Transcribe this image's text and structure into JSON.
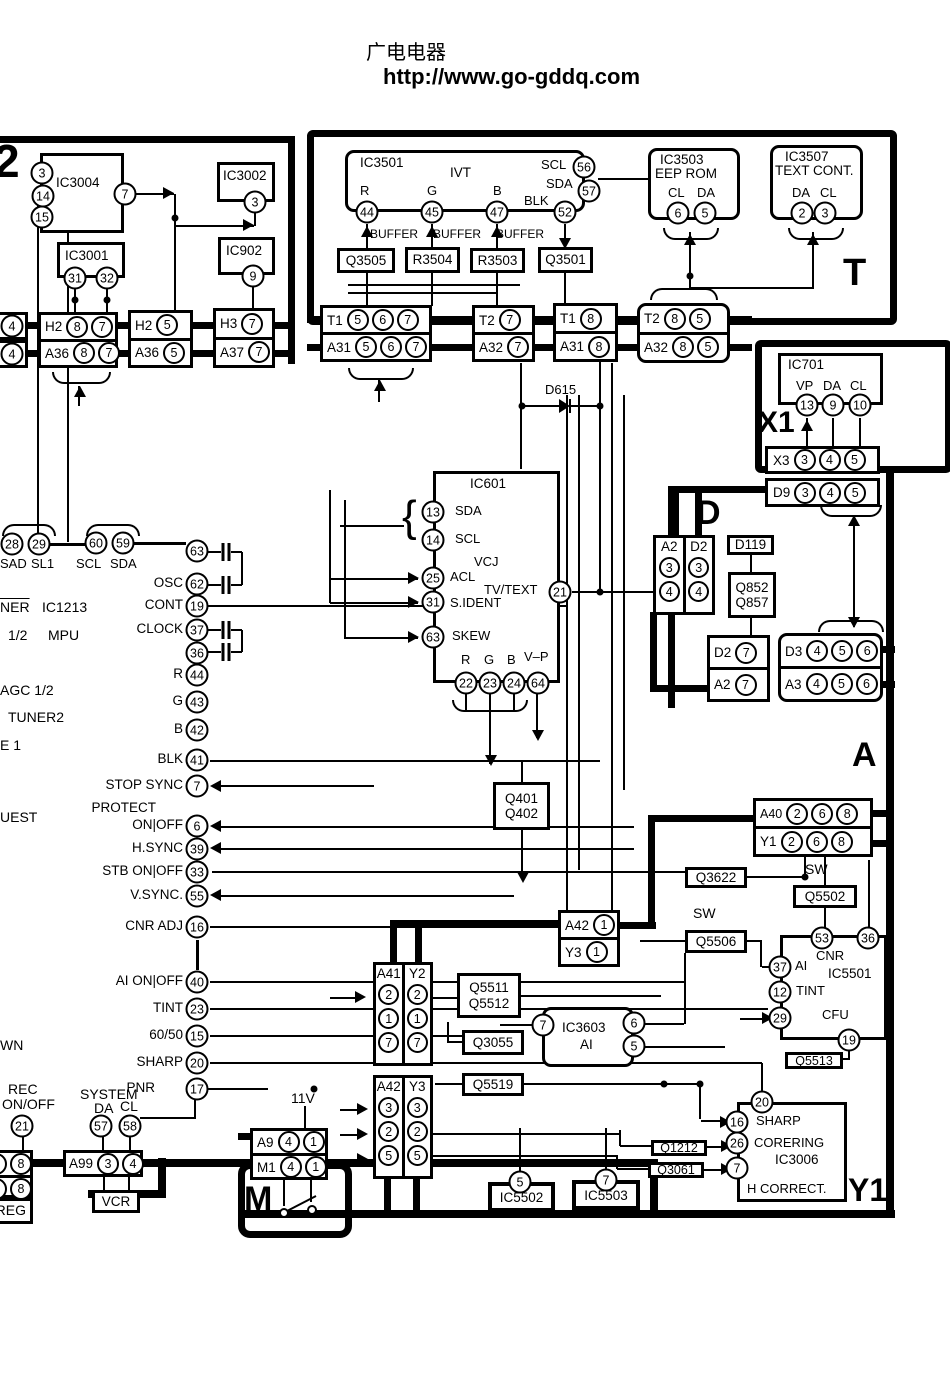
{
  "header": {
    "site": "广电电器",
    "url": "http://www.go-gddq.com"
  },
  "sections": {
    "s2": "2",
    "t": "T",
    "x1": "X1",
    "d": "D",
    "a": "A",
    "m": "M",
    "y1": "Y1"
  },
  "top_left": {
    "ic3004": {
      "t": "IC3004",
      "p3": "3",
      "p14": "14",
      "p15": "15",
      "p7": "7"
    },
    "ic3002": {
      "t": "IC3002",
      "p3": "3"
    },
    "ic3001": {
      "t": "IC3001",
      "p31": "31",
      "p32": "32"
    },
    "ic902": {
      "t": "IC902",
      "p9": "9"
    },
    "edge": {
      "r1": "4",
      "r2": "4"
    },
    "hbox1": {
      "l1": "H2",
      "p11": "8",
      "p12": "7",
      "l2": "A36",
      "p21": "8",
      "p22": "7"
    },
    "hbox2": {
      "l1": "H2",
      "p11": "5",
      "l2": "A36",
      "p21": "5"
    },
    "hbox3": {
      "l1": "H3",
      "p11": "7",
      "l2": "A37",
      "p21": "7"
    }
  },
  "t_sec": {
    "ic3501": {
      "t": "IC3501",
      "sub": "IVT",
      "lr": "R",
      "lg": "G",
      "lb": "B",
      "lblk": "BLK",
      "lscl": "SCL",
      "lsda": "SDA",
      "p44": "44",
      "p45": "45",
      "p47": "47",
      "p52": "52",
      "p56": "56",
      "p57": "57"
    },
    "buf": "BUFFER",
    "q3505": "Q3505",
    "r3504": "R3504",
    "r3503": "R3503",
    "q3501": "Q3501",
    "ic3503": {
      "t": "IC3503",
      "sub": "EEP ROM",
      "lcl": "CL",
      "lda": "DA",
      "p6": "6",
      "p5": "5"
    },
    "ic3507": {
      "t": "IC3507",
      "sub": "TEXT CONT.",
      "lda": "DA",
      "lcl": "CL",
      "p2": "2",
      "p3": "3"
    },
    "tbox1": {
      "l1": "T1",
      "p1": [
        "5",
        "6",
        "7"
      ],
      "l2": "A31",
      "p2": [
        "5",
        "6",
        "7"
      ]
    },
    "tbox2": {
      "l1": "T2",
      "p1": [
        "7"
      ],
      "l2": "A32",
      "p2": [
        "7"
      ]
    },
    "tbox3": {
      "l1": "T1",
      "p1": [
        "8"
      ],
      "l2": "A31",
      "p2": [
        "8"
      ]
    },
    "tbox4": {
      "l1": "T2",
      "p1": [
        "8",
        "5"
      ],
      "l2": "A32",
      "p2": [
        "8",
        "5"
      ]
    },
    "d615": "D615"
  },
  "x1_sec": {
    "ic701": {
      "t": "IC701",
      "lvp": "VP",
      "lda": "DA",
      "lcl": "CL",
      "p13": "13",
      "p9": "9",
      "p10": "10"
    },
    "x3": {
      "l": "X3",
      "p": [
        "3",
        "4",
        "5"
      ]
    },
    "d9": {
      "l": "D9",
      "p": [
        "3",
        "4",
        "5"
      ]
    }
  },
  "mpu": {
    "p28": "28",
    "p29": "29",
    "lsad": "SAD",
    "lsl1": "SL1",
    "p60": "60",
    "p59": "59",
    "lscl": "SCL",
    "lsda": "SDA",
    "f_ner": "NER",
    "f_ic1213": "IC1213",
    "f_half": "1/2",
    "f_mpu": "MPU",
    "f_agc": "AGC 1/2",
    "f_tuner2": "TUNER2",
    "f_e1": "E 1",
    "f_uest": "UEST",
    "f_wn": "WN",
    "pins": [
      {
        "l": "",
        "n": "63"
      },
      {
        "l": "OSC",
        "n": "62"
      },
      {
        "l": "CONT",
        "n": "19"
      },
      {
        "l": "CLOCK",
        "n": "37"
      },
      {
        "l": "",
        "n": "36"
      },
      {
        "l": "R",
        "n": "44"
      },
      {
        "l": "G",
        "n": "43"
      },
      {
        "l": "B",
        "n": "42"
      },
      {
        "l": "BLK",
        "n": "41"
      },
      {
        "l": "STOP SYNC",
        "n": "7"
      },
      {
        "l": "ON|OFF",
        "n": "6",
        "pre": "PROTECT"
      },
      {
        "l": "H.SYNC",
        "n": "39"
      },
      {
        "l": "STB ON|OFF",
        "n": "33"
      },
      {
        "l": "V.SYNC.",
        "n": "55"
      },
      {
        "l": "CNR ADJ",
        "n": "16"
      },
      {
        "l": "AI ON|OFF",
        "n": "40"
      },
      {
        "l": "TINT",
        "n": "23"
      },
      {
        "l": "60/50",
        "n": "15"
      },
      {
        "l": "SHARP",
        "n": "20"
      },
      {
        "l": "PNR",
        "n": "17"
      }
    ],
    "rec1": "REC",
    "rec2": "ON/OFF",
    "p21": "21",
    "system": "SYSTEM",
    "lda": "DA",
    "lcl": "CL",
    "p57": "57",
    "p58": "58"
  },
  "ic601": {
    "t": "IC601",
    "p13": "13",
    "lsda": "SDA",
    "p14": "14",
    "lscl": "SCL",
    "lvcj": "VCJ",
    "p25": "25",
    "lacl": "ACL",
    "ltv": "TV/TEXT",
    "p21": "21",
    "p31": "31",
    "lsident": "S.IDENT",
    "p63": "63",
    "lskew": "SKEW",
    "lr": "R",
    "lg": "G",
    "lb": "B",
    "lvp": "V–P",
    "p22": "22",
    "p23": "23",
    "p24": "24",
    "p64": "64"
  },
  "d_sec": {
    "cols": {
      "h1": "A2",
      "h2": "D2",
      "r1a": "3",
      "r1b": "3",
      "r2a": "4",
      "r2b": "4"
    },
    "d119": "D119",
    "q852": "Q852",
    "q857": "Q857",
    "box2": {
      "l1": "D2",
      "p1": "7",
      "l2": "A2",
      "p2": "7"
    },
    "box3": {
      "l1": "D3",
      "p1": [
        "4",
        "5",
        "6"
      ],
      "l2": "A3",
      "p2": [
        "4",
        "5",
        "6"
      ]
    }
  },
  "mid": {
    "q401": "Q401",
    "q402": "Q402",
    "a40": {
      "l1": "A40",
      "p1": [
        "2",
        "6",
        "8"
      ],
      "l2": "Y1",
      "p2": [
        "2",
        "6",
        "8"
      ]
    },
    "q3622": "Q3622",
    "sw1": "SW",
    "q5502": "Q5502",
    "sw2": "SW",
    "q5506": "Q5506",
    "a42a": {
      "l1": "A42",
      "p1": "1",
      "l2": "Y3",
      "p2": "1"
    }
  },
  "ic5501": {
    "t": "IC5501",
    "p53": "53",
    "p36": "36",
    "p37": "37",
    "lai": "AI",
    "lcnr": "CNR",
    "p12": "12",
    "ltint": "TINT",
    "p29": "29",
    "lcfu": "CFU",
    "p19": "19",
    "q5513": "Q5513"
  },
  "bot": {
    "a41": {
      "h1": "A41",
      "h2": "Y2",
      "rows": [
        [
          "2",
          "2"
        ],
        [
          "1",
          "1"
        ],
        [
          "7",
          "7"
        ]
      ]
    },
    "q5511": "Q5511",
    "q5512": "Q5512",
    "q3055": "Q3055",
    "ic3603": {
      "t": "IC3603",
      "sub": "AI",
      "p7": "7",
      "p6": "6",
      "p5": "5"
    },
    "q5519": "Q5519",
    "a42b": {
      "h1": "A42",
      "h2": "Y3",
      "rows": [
        [
          "3",
          "3"
        ],
        [
          "2",
          "2"
        ],
        [
          "5",
          "5"
        ]
      ]
    },
    "v11": "11V",
    "a9": {
      "l1": "A9",
      "p1": [
        "4",
        "1"
      ],
      "l2": "M1",
      "p2": [
        "4",
        "1"
      ]
    },
    "a99": {
      "l": "A99",
      "p3": "3",
      "p4": "4"
    },
    "vcr": "VCR",
    "reg": "REG",
    "edge": {
      "rows": [
        [
          "4",
          "8"
        ],
        [
          "4",
          "8"
        ]
      ]
    },
    "ic5502": {
      "t": "IC5502",
      "p": "5"
    },
    "ic5503": {
      "t": "IC5503",
      "p": "7"
    },
    "q1212": "Q1212",
    "q3061": "Q3061",
    "ic3006": {
      "p20": "20",
      "p16": "16",
      "lsharp": "SHARP",
      "p26": "26",
      "lcorering": "CORERING",
      "t": "IC3006",
      "p7": "7",
      "lhcorrect": "H CORRECT."
    }
  }
}
